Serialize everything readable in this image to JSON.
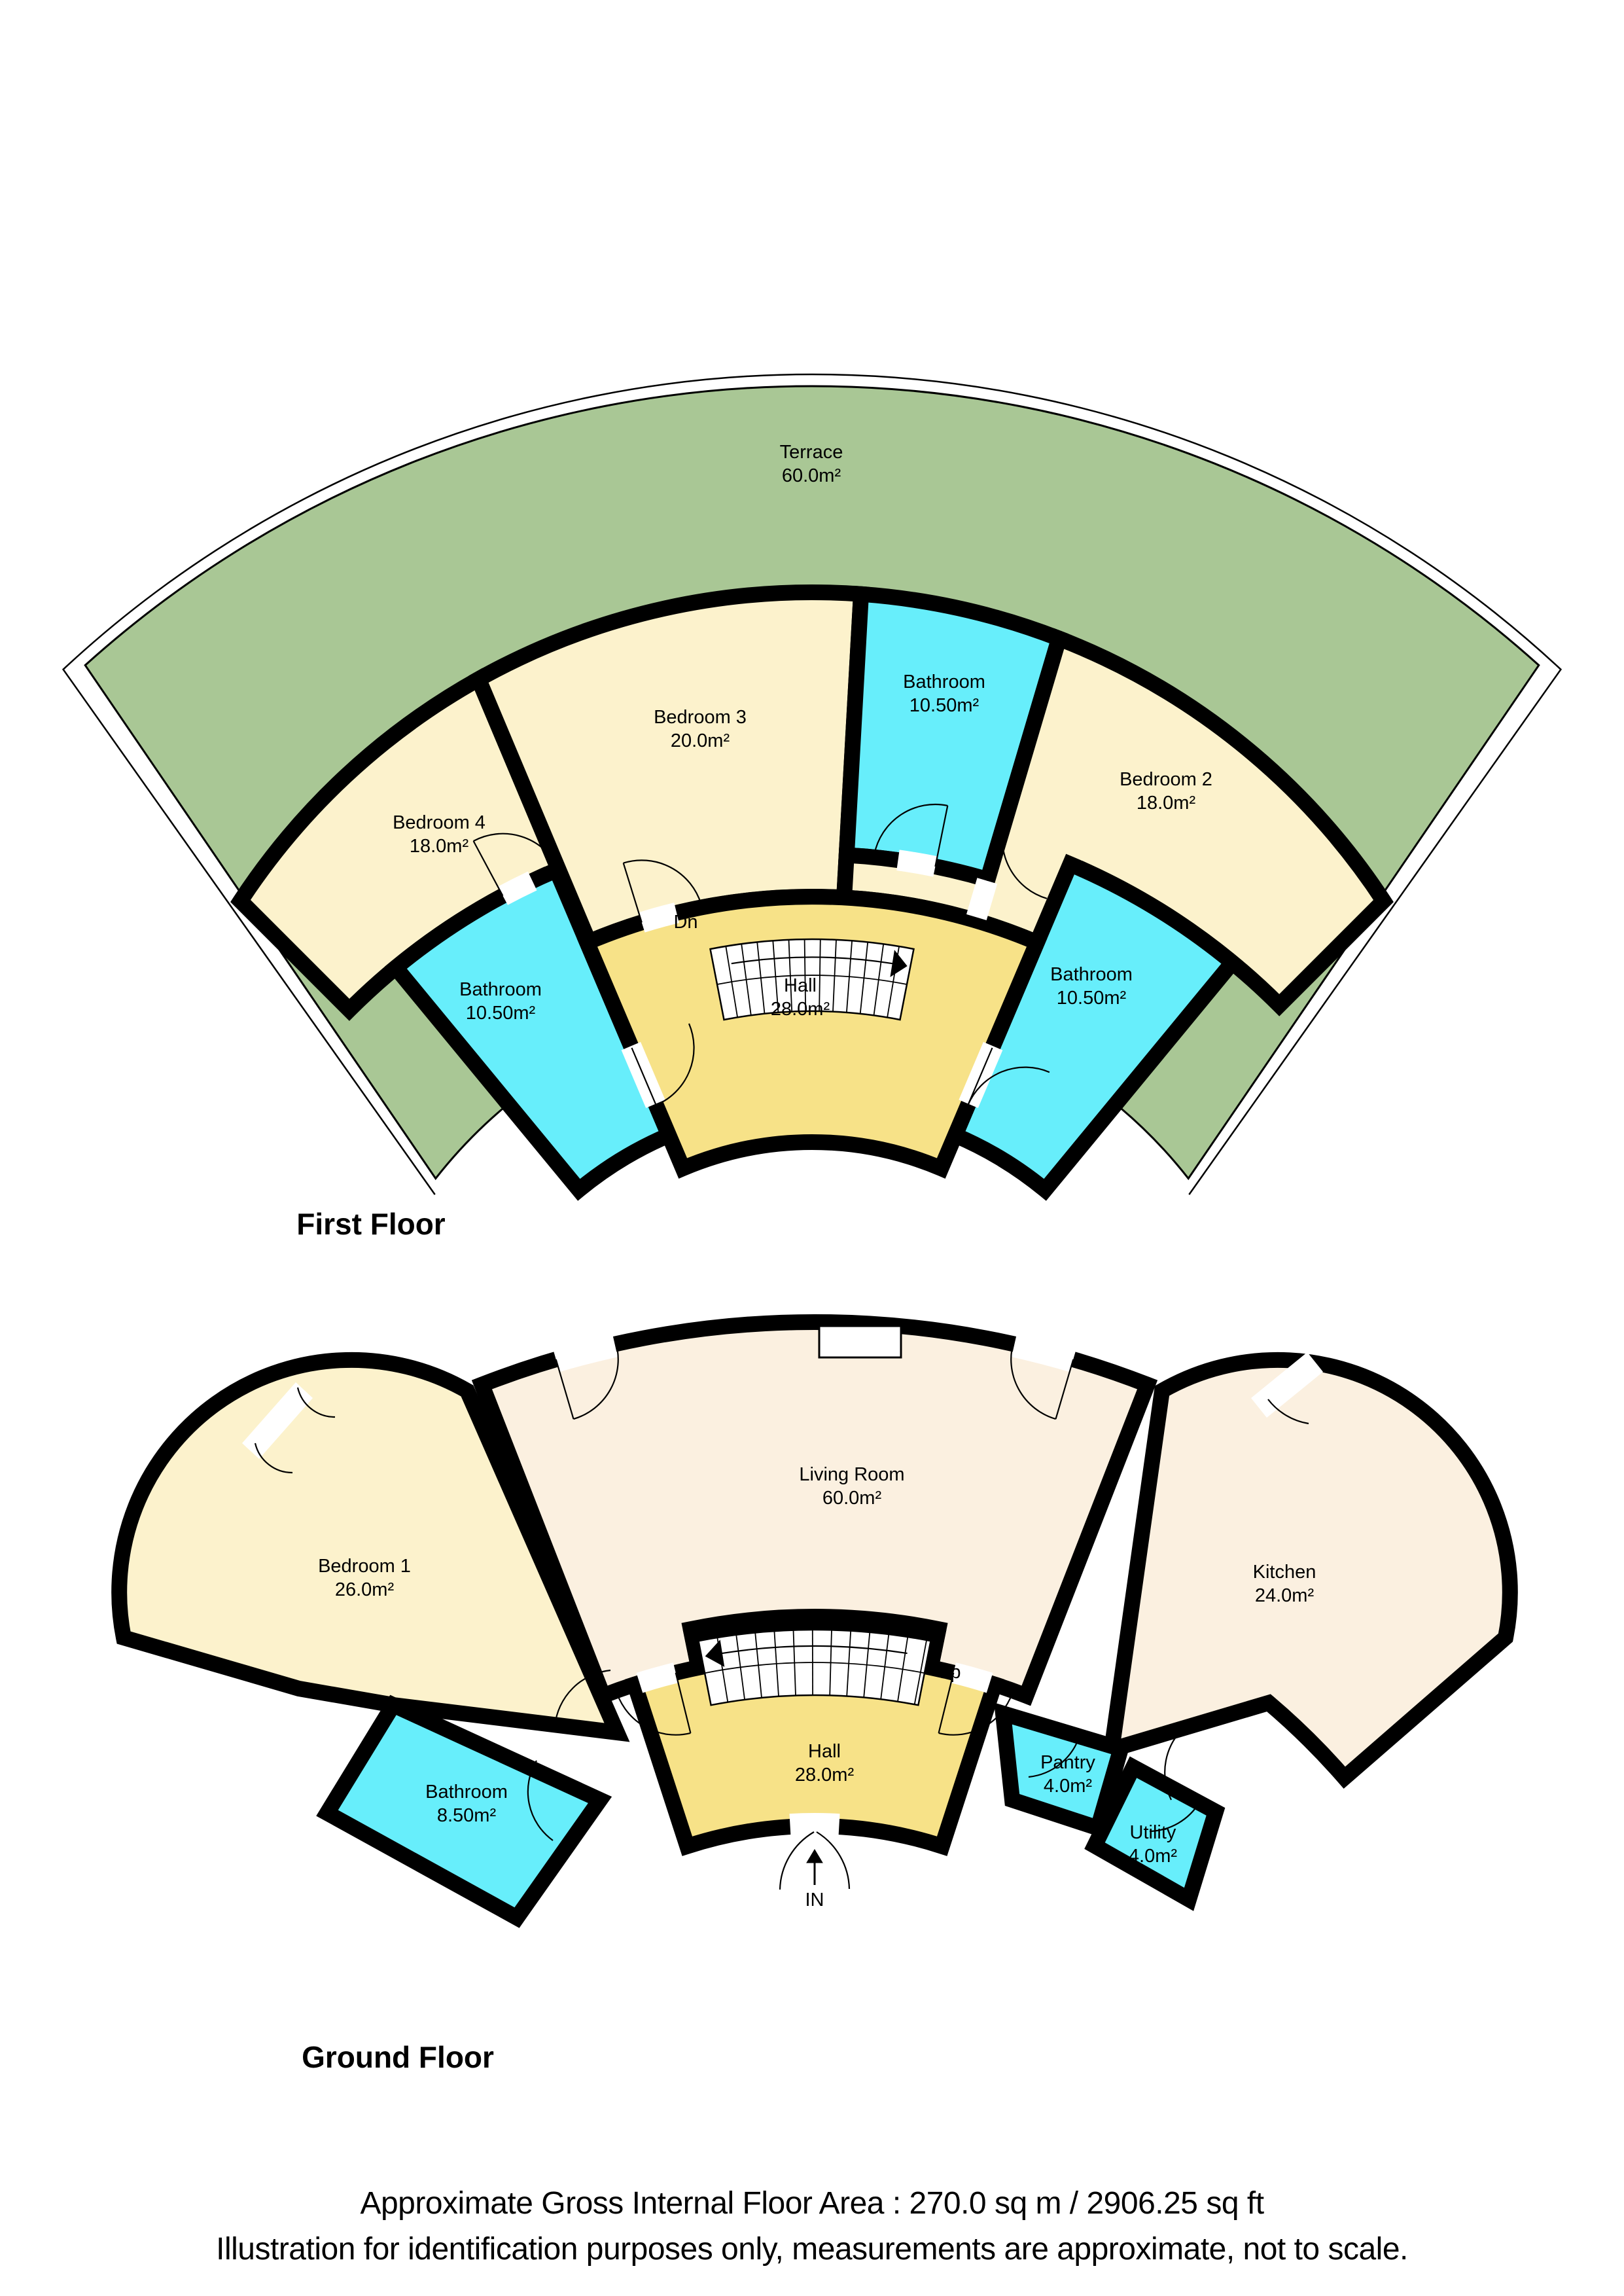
{
  "colors": {
    "terrace_green": "#a9c795",
    "bedroom_cream": "#fcf2cc",
    "living_cream": "#fbf0e0",
    "hall_yellow": "#f7e288",
    "bathroom_cyan": "#67eefb",
    "wall_black": "#000000",
    "stair_white": "#ffffff"
  },
  "first_floor": {
    "title": "First Floor",
    "stairs_label": "Dn",
    "rooms": [
      {
        "name": "Terrace",
        "area": "60.0m²"
      },
      {
        "name": "Bedroom 3",
        "area": "20.0m²"
      },
      {
        "name": "Bathroom",
        "area": "10.50m²"
      },
      {
        "name": "Bedroom 2",
        "area": "18.0m²"
      },
      {
        "name": "Bedroom 4",
        "area": "18.0m²"
      },
      {
        "name": "Bathroom",
        "area": "10.50m²"
      },
      {
        "name": "Bathroom",
        "area": "10.50m²"
      },
      {
        "name": "Hall",
        "area": "28.0m²"
      }
    ]
  },
  "ground_floor": {
    "title": "Ground Floor",
    "stairs_label": "Up",
    "entrance_label": "IN",
    "rooms": [
      {
        "name": "Living Room",
        "area": "60.0m²"
      },
      {
        "name": "Bedroom 1",
        "area": "26.0m²"
      },
      {
        "name": "Kitchen",
        "area": "24.0m²"
      },
      {
        "name": "Hall",
        "area": "28.0m²"
      },
      {
        "name": "Bathroom",
        "area": "8.50m²"
      },
      {
        "name": "Pantry",
        "area": "4.0m²"
      },
      {
        "name": "Utility",
        "area": "4.0m²"
      }
    ]
  },
  "footer": {
    "line1": "Approximate Gross Internal Floor Area : 270.0 sq m / 2906.25 sq ft",
    "line2": "Illustration for identification purposes only, measurements are approximate, not to scale."
  }
}
